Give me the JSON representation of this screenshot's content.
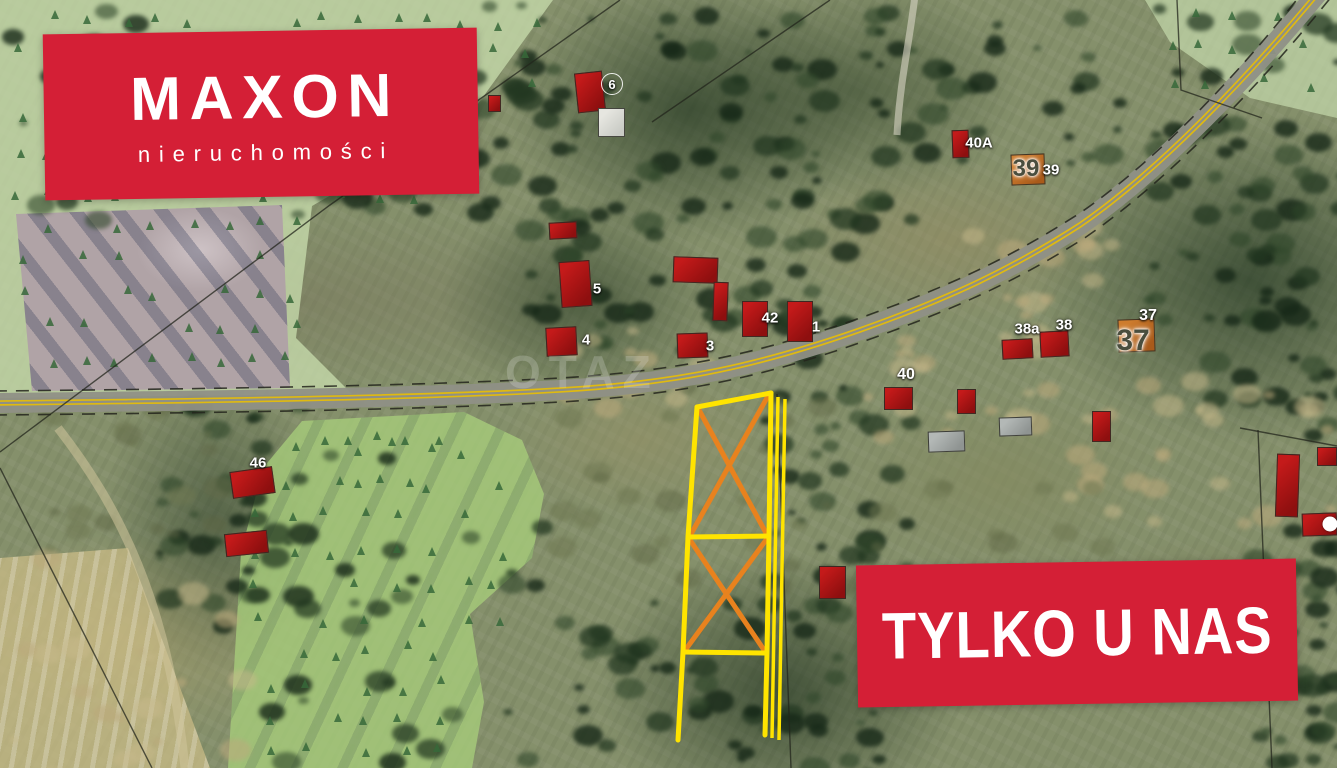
{
  "branding": {
    "logo_title": "MAXON",
    "logo_subtitle": "nieruchomości",
    "badge_text": "TYLKO U NAS",
    "brand_red": "#d41f36"
  },
  "map": {
    "watermark": "OTAZ",
    "colors": {
      "plot_outline": "#ffe400",
      "plot_cross": "#e8821e",
      "road_casing": "#8f9086",
      "road_line": "#e0ba10",
      "cadastral_line": "#23251c",
      "house_red": "#b01414",
      "house_orange": "#c9772b"
    },
    "house_labels": [
      {
        "text": "6",
        "x": 612,
        "y": 84,
        "style": "white circled",
        "size": 13
      },
      {
        "text": "5",
        "x": 597,
        "y": 289,
        "style": "white",
        "size": 15
      },
      {
        "text": "4",
        "x": 586,
        "y": 340,
        "style": "white",
        "size": 15
      },
      {
        "text": "3",
        "x": 710,
        "y": 346,
        "style": "white",
        "size": 15
      },
      {
        "text": "42",
        "x": 770,
        "y": 318,
        "style": "white",
        "size": 15
      },
      {
        "text": "1",
        "x": 816,
        "y": 327,
        "style": "white",
        "size": 15
      },
      {
        "text": "40",
        "x": 906,
        "y": 375,
        "style": "white",
        "size": 16
      },
      {
        "text": "38a",
        "x": 1027,
        "y": 329,
        "style": "white",
        "size": 15
      },
      {
        "text": "38",
        "x": 1064,
        "y": 325,
        "style": "white",
        "size": 15
      },
      {
        "text": "37",
        "x": 1148,
        "y": 316,
        "style": "white",
        "size": 16
      },
      {
        "text": "37",
        "x": 1133,
        "y": 341,
        "style": "dark",
        "size": 30
      },
      {
        "text": "39",
        "x": 1026,
        "y": 169,
        "style": "dark",
        "size": 24
      },
      {
        "text": "39",
        "x": 1051,
        "y": 170,
        "style": "white",
        "size": 15
      },
      {
        "text": "40A",
        "x": 979,
        "y": 143,
        "style": "white",
        "size": 15
      },
      {
        "text": "46",
        "x": 258,
        "y": 463,
        "style": "white",
        "size": 15
      },
      {
        "text": "",
        "x": 1330,
        "y": 524,
        "style": "dot",
        "size": 15
      }
    ],
    "houses": [
      {
        "x": 488,
        "y": 95,
        "w": 13,
        "h": 17,
        "r": 0,
        "c": "red"
      },
      {
        "x": 576,
        "y": 72,
        "w": 28,
        "h": 40,
        "r": -6,
        "c": "red"
      },
      {
        "x": 598,
        "y": 108,
        "w": 27,
        "h": 29,
        "r": 0,
        "c": "white"
      },
      {
        "x": 549,
        "y": 222,
        "w": 28,
        "h": 17,
        "r": -3,
        "c": "red"
      },
      {
        "x": 560,
        "y": 261,
        "w": 31,
        "h": 46,
        "r": -4,
        "c": "red"
      },
      {
        "x": 546,
        "y": 327,
        "w": 31,
        "h": 29,
        "r": -3,
        "c": "red"
      },
      {
        "x": 673,
        "y": 257,
        "w": 45,
        "h": 26,
        "r": 2,
        "c": "red"
      },
      {
        "x": 713,
        "y": 282,
        "w": 15,
        "h": 39,
        "r": 2,
        "c": "red"
      },
      {
        "x": 677,
        "y": 333,
        "w": 31,
        "h": 25,
        "r": -2,
        "c": "red"
      },
      {
        "x": 742,
        "y": 301,
        "w": 26,
        "h": 36,
        "r": 0,
        "c": "red"
      },
      {
        "x": 787,
        "y": 301,
        "w": 26,
        "h": 41,
        "r": 0,
        "c": "red"
      },
      {
        "x": 884,
        "y": 387,
        "w": 29,
        "h": 23,
        "r": 0,
        "c": "red"
      },
      {
        "x": 957,
        "y": 389,
        "w": 19,
        "h": 25,
        "r": 0,
        "c": "red"
      },
      {
        "x": 928,
        "y": 431,
        "w": 37,
        "h": 21,
        "r": -2,
        "c": "grey"
      },
      {
        "x": 999,
        "y": 417,
        "w": 33,
        "h": 19,
        "r": -2,
        "c": "grey"
      },
      {
        "x": 1092,
        "y": 411,
        "w": 19,
        "h": 31,
        "r": 0,
        "c": "red"
      },
      {
        "x": 1002,
        "y": 339,
        "w": 31,
        "h": 20,
        "r": -3,
        "c": "red"
      },
      {
        "x": 1040,
        "y": 331,
        "w": 29,
        "h": 26,
        "r": -3,
        "c": "red"
      },
      {
        "x": 1118,
        "y": 319,
        "w": 37,
        "h": 33,
        "r": -2,
        "c": "orange"
      },
      {
        "x": 1011,
        "y": 154,
        "w": 34,
        "h": 31,
        "r": -2,
        "c": "orange"
      },
      {
        "x": 952,
        "y": 130,
        "w": 17,
        "h": 28,
        "r": -2,
        "c": "red"
      },
      {
        "x": 231,
        "y": 469,
        "w": 43,
        "h": 27,
        "r": -8,
        "c": "red"
      },
      {
        "x": 225,
        "y": 532,
        "w": 43,
        "h": 23,
        "r": -6,
        "c": "red"
      },
      {
        "x": 1276,
        "y": 454,
        "w": 23,
        "h": 63,
        "r": 2,
        "c": "red"
      },
      {
        "x": 1317,
        "y": 447,
        "w": 20,
        "h": 19,
        "r": 0,
        "c": "red"
      },
      {
        "x": 1302,
        "y": 513,
        "w": 35,
        "h": 23,
        "r": -2,
        "c": "red"
      },
      {
        "x": 819,
        "y": 566,
        "w": 27,
        "h": 33,
        "r": 0,
        "c": "red"
      }
    ],
    "plot": {
      "outline": [
        "697,407 771,393",
        "697,407 688,537 683,652 678,740",
        "771,393 769,536 767,653 765,735",
        "688,537 769,536",
        "683,652 767,653"
      ],
      "crosses": [
        "699,410 766,533",
        "768,396 691,534",
        "690,540 764,650",
        "766,540 686,649"
      ],
      "strip": [
        "778,397 772,738",
        "785,399 779,740"
      ]
    },
    "roads": {
      "main": "M-6,403 C200,401 420,398 560,390 C680,383 760,365 860,330 C950,298 1010,270 1080,225 C1160,170 1250,75 1322,-12",
      "edge_dashes": [
        "M-6,391 C200,389 420,386 560,378 C680,371 760,353 860,318 C950,286 1010,258 1080,213 C1160,158 1246,67 1312,-20",
        "M-6,415 C200,413 420,410 560,402 C680,395 762,377 862,342 C952,310 1016,282 1086,237 C1166,182 1258,88 1332,-4"
      ],
      "tracks": [
        {
          "d": "M915,-5 C910,40 900,80 897,135",
          "color": "#d9d5c4",
          "w": 7,
          "o": 0.6
        },
        {
          "d": "M58,428 C118,505 168,600 185,768",
          "color": "#cfc49b",
          "w": 9,
          "o": 0.55
        }
      ]
    },
    "cadastral": [
      "M620,0 L330,205 L0,452",
      "M830,0 L652,122",
      "M777,394 L791,768",
      "M1177,0 L1181,90 L1262,118",
      "M1240,428 L1337,446",
      "M1258,430 L1272,768",
      "M0,468 L152,768"
    ]
  }
}
